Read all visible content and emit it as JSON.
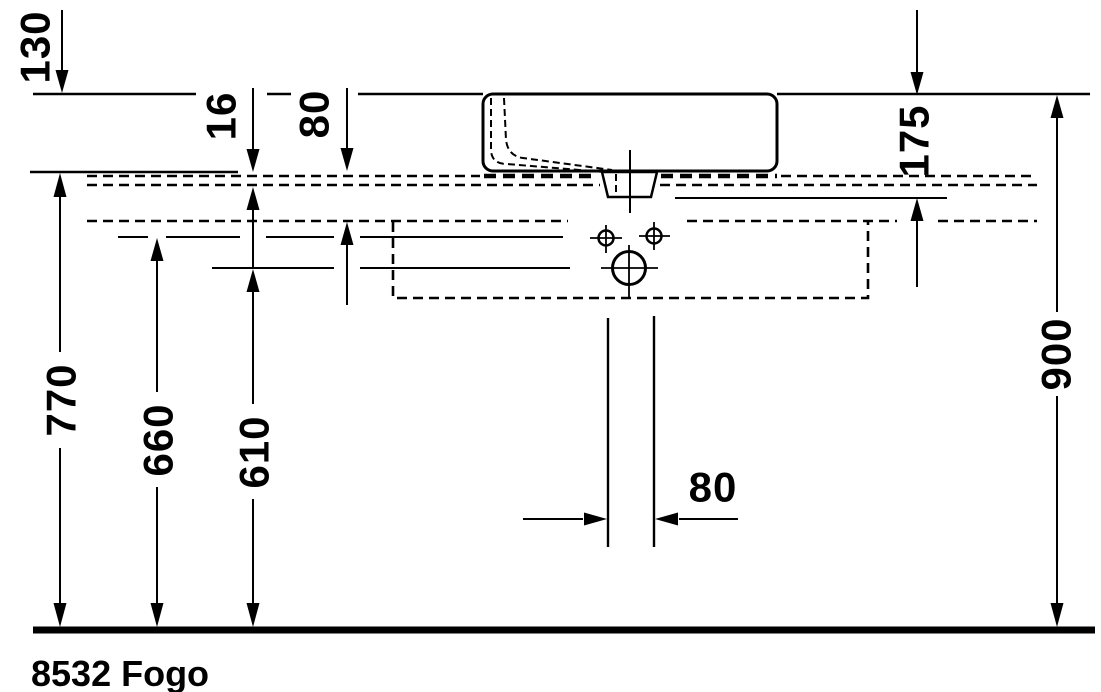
{
  "drawing": {
    "type": "technical-dimension-drawing",
    "unit": "mm",
    "background_color": "#ffffff",
    "line_color": "#000000",
    "labels": {
      "d130": "130",
      "d16": "16",
      "d80v": "80",
      "d175": "175",
      "d770": "770",
      "d660": "660",
      "d610": "610",
      "d900": "900",
      "d80h": "80",
      "product": "8532 Fogo"
    },
    "dimension_values_mm": [
      {
        "value": 130,
        "orientation": "vertical"
      },
      {
        "value": 16,
        "orientation": "vertical"
      },
      {
        "value": 80,
        "orientation": "vertical"
      },
      {
        "value": 175,
        "orientation": "vertical"
      },
      {
        "value": 770,
        "orientation": "vertical"
      },
      {
        "value": 660,
        "orientation": "vertical"
      },
      {
        "value": 610,
        "orientation": "vertical"
      },
      {
        "value": 900,
        "orientation": "vertical"
      },
      {
        "value": 80,
        "orientation": "horizontal"
      }
    ]
  }
}
